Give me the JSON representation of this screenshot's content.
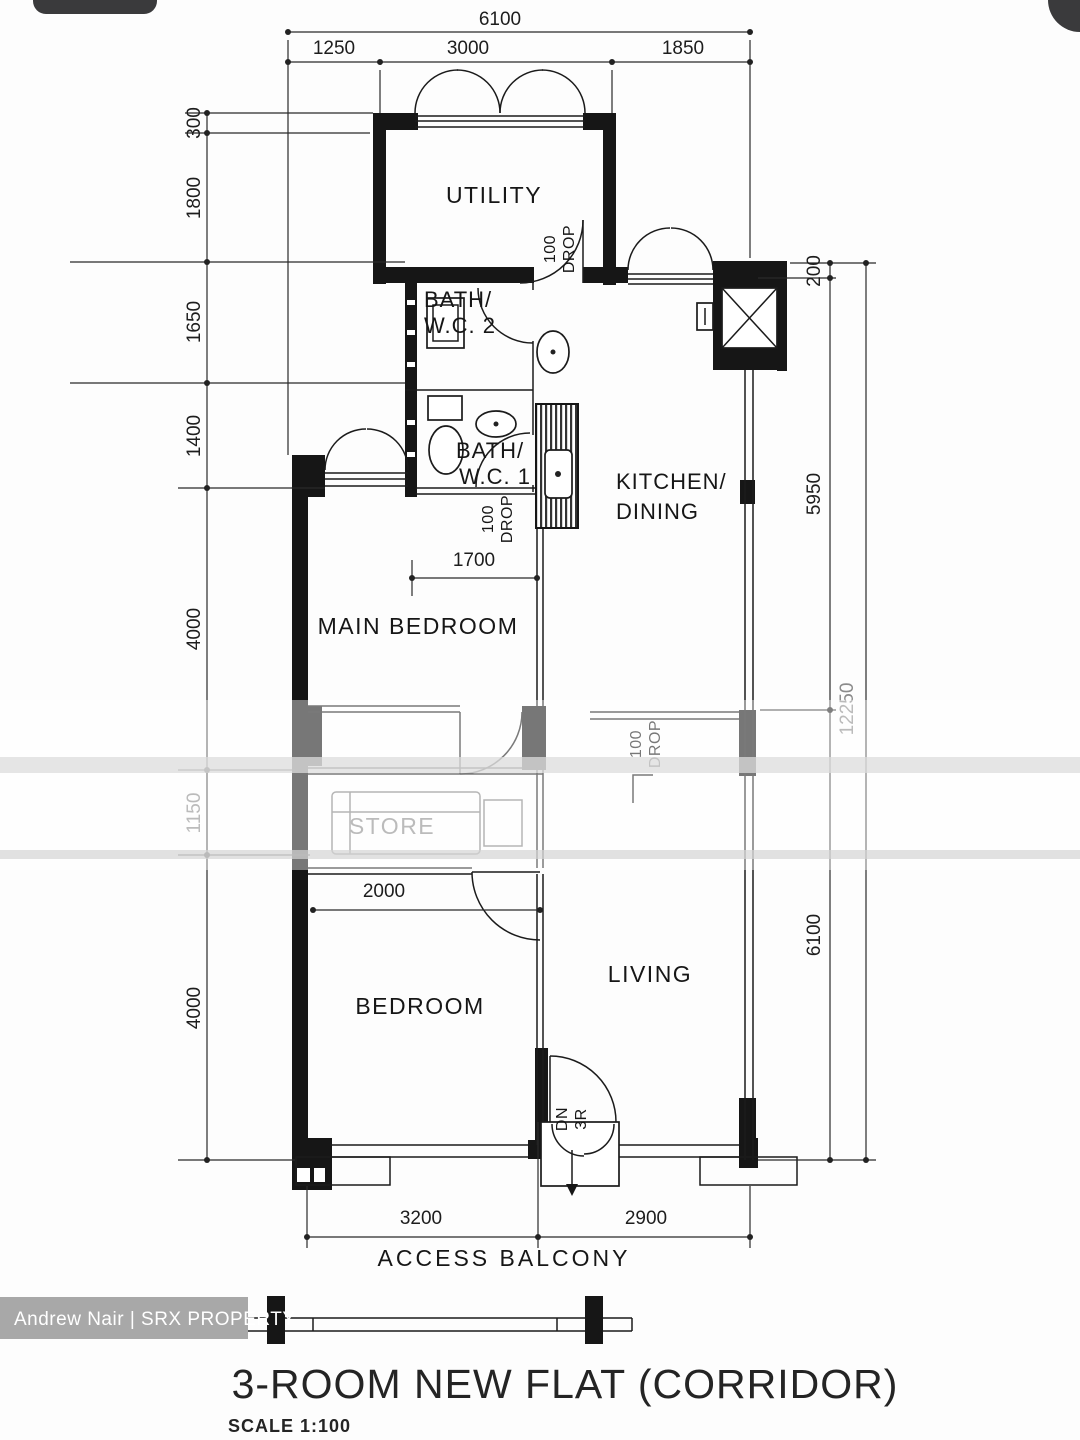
{
  "colors": {
    "ink": "#1b1b1b",
    "faded": "#8b8b8b",
    "watermark_bg": "#a8a8a8",
    "watermark_text": "#ffffff",
    "chrome": "#3a3a3c",
    "paper": "#fdfdfd"
  },
  "dims": {
    "top_total": "6100",
    "top": [
      "1250",
      "3000",
      "1850"
    ],
    "left": [
      "300",
      "1800",
      "1650",
      "1400",
      "4000",
      "1150",
      "4000"
    ],
    "right": [
      "200",
      "5950",
      "6100"
    ],
    "right_total": "12250",
    "inner": {
      "bedroom_window": "1700",
      "store_width": "2000"
    },
    "bottom": [
      "3200",
      "2900"
    ]
  },
  "rooms": {
    "utility": "UTILITY",
    "bath2": [
      "BATH/",
      "W.C. 2"
    ],
    "bath1": [
      "BATH/",
      "W.C. 1"
    ],
    "kitchen": [
      "KITCHEN/",
      "DINING"
    ],
    "main_bedroom": "MAIN BEDROOM",
    "store": "STORE",
    "bedroom": "BEDROOM",
    "living": "LIVING",
    "access_balcony": "ACCESS BALCONY"
  },
  "notes": {
    "drop": [
      "100",
      "DROP"
    ],
    "down": [
      "DN",
      "3R"
    ]
  },
  "title_block": {
    "title": "3-ROOM NEW FLAT (CORRIDOR)",
    "scale": "SCALE 1:100"
  },
  "watermark": {
    "credit": "Andrew Nair | SRX PROPERTY"
  }
}
